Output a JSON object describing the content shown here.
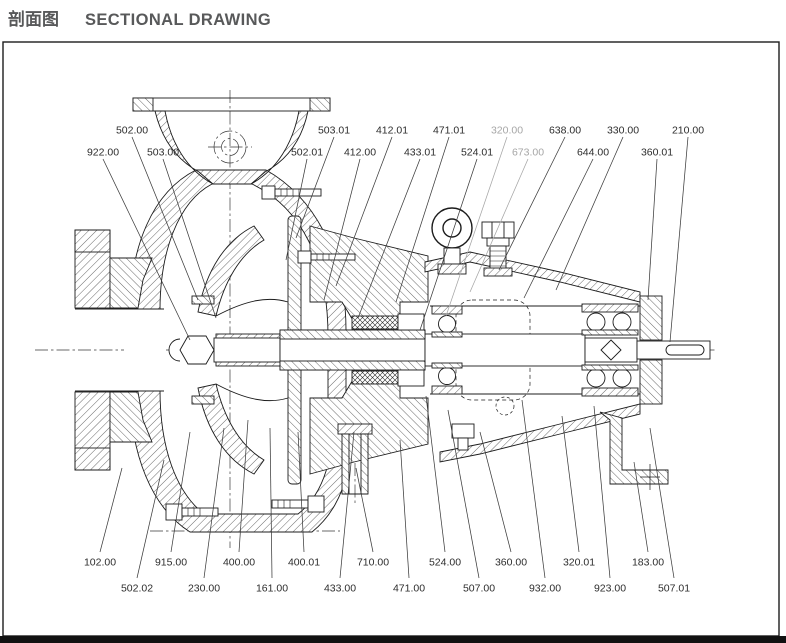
{
  "header": {
    "title_zh": "剖面图",
    "title_en": "SECTIONAL DRAWING"
  },
  "colors": {
    "title": "#58595a",
    "line": "#1c1c1c",
    "label": "#2d2d2d",
    "muted_label": "#a6a6a6",
    "frame": "#1c1c1c"
  },
  "drawing": {
    "type": "centrifugal-pump-sectional-drawing",
    "labels": [
      {
        "text": "502.00",
        "x": 132,
        "y": 130,
        "tx": 198,
        "ty": 300,
        "row": "top",
        "muted": false
      },
      {
        "text": "503.01",
        "x": 334,
        "y": 130,
        "tx": 296,
        "ty": 238,
        "row": "top",
        "muted": false
      },
      {
        "text": "412.01",
        "x": 392,
        "y": 130,
        "tx": 336,
        "ty": 286,
        "row": "top",
        "muted": false
      },
      {
        "text": "471.01",
        "x": 449,
        "y": 130,
        "tx": 396,
        "ty": 302,
        "row": "top",
        "muted": false
      },
      {
        "text": "320.00",
        "x": 507,
        "y": 130,
        "tx": 446,
        "ty": 316,
        "row": "top",
        "muted": true
      },
      {
        "text": "638.00",
        "x": 565,
        "y": 130,
        "tx": 499,
        "ty": 270,
        "row": "top",
        "muted": false
      },
      {
        "text": "330.00",
        "x": 623,
        "y": 130,
        "tx": 556,
        "ty": 290,
        "row": "top",
        "muted": false
      },
      {
        "text": "210.00",
        "x": 688,
        "y": 130,
        "tx": 670,
        "ty": 342,
        "row": "top",
        "muted": false
      },
      {
        "text": "922.00",
        "x": 103,
        "y": 152,
        "tx": 190,
        "ty": 340,
        "row": "top",
        "muted": false
      },
      {
        "text": "503.00",
        "x": 163,
        "y": 152,
        "tx": 216,
        "ty": 318,
        "row": "top",
        "muted": false
      },
      {
        "text": "502.01",
        "x": 307,
        "y": 152,
        "tx": 286,
        "ty": 260,
        "row": "top",
        "muted": false
      },
      {
        "text": "412.00",
        "x": 360,
        "y": 152,
        "tx": 324,
        "ty": 300,
        "row": "top",
        "muted": false
      },
      {
        "text": "433.01",
        "x": 420,
        "y": 152,
        "tx": 358,
        "ty": 318,
        "row": "top",
        "muted": false
      },
      {
        "text": "524.01",
        "x": 477,
        "y": 152,
        "tx": 420,
        "ty": 330,
        "row": "top",
        "muted": false
      },
      {
        "text": "673.00",
        "x": 528,
        "y": 152,
        "tx": 470,
        "ty": 292,
        "row": "top",
        "muted": true
      },
      {
        "text": "644.00",
        "x": 593,
        "y": 152,
        "tx": 524,
        "ty": 298,
        "row": "top",
        "muted": false
      },
      {
        "text": "360.01",
        "x": 657,
        "y": 152,
        "tx": 648,
        "ty": 300,
        "row": "top",
        "muted": false
      },
      {
        "text": "102.00",
        "x": 100,
        "y": 562,
        "tx": 122,
        "ty": 468,
        "row": "bottom",
        "muted": false
      },
      {
        "text": "915.00",
        "x": 171,
        "y": 562,
        "tx": 190,
        "ty": 432,
        "row": "bottom",
        "muted": false
      },
      {
        "text": "400.00",
        "x": 239,
        "y": 562,
        "tx": 248,
        "ty": 420,
        "row": "bottom",
        "muted": false
      },
      {
        "text": "400.01",
        "x": 304,
        "y": 562,
        "tx": 298,
        "ty": 432,
        "row": "bottom",
        "muted": false
      },
      {
        "text": "710.00",
        "x": 373,
        "y": 562,
        "tx": 356,
        "ty": 468,
        "row": "bottom",
        "muted": false
      },
      {
        "text": "524.00",
        "x": 445,
        "y": 562,
        "tx": 426,
        "ty": 396,
        "row": "bottom",
        "muted": false
      },
      {
        "text": "360.00",
        "x": 511,
        "y": 562,
        "tx": 480,
        "ty": 432,
        "row": "bottom",
        "muted": false
      },
      {
        "text": "320.01",
        "x": 579,
        "y": 562,
        "tx": 562,
        "ty": 416,
        "row": "bottom",
        "muted": false
      },
      {
        "text": "183.00",
        "x": 648,
        "y": 562,
        "tx": 634,
        "ty": 462,
        "row": "bottom",
        "muted": false
      },
      {
        "text": "502.02",
        "x": 137,
        "y": 588,
        "tx": 164,
        "ty": 460,
        "row": "bottom",
        "muted": false
      },
      {
        "text": "230.00",
        "x": 204,
        "y": 588,
        "tx": 224,
        "ty": 428,
        "row": "bottom",
        "muted": false
      },
      {
        "text": "161.00",
        "x": 272,
        "y": 588,
        "tx": 270,
        "ty": 428,
        "row": "bottom",
        "muted": false
      },
      {
        "text": "433.00",
        "x": 340,
        "y": 588,
        "tx": 354,
        "ty": 432,
        "row": "bottom",
        "muted": false
      },
      {
        "text": "471.00",
        "x": 409,
        "y": 588,
        "tx": 400,
        "ty": 440,
        "row": "bottom",
        "muted": false
      },
      {
        "text": "507.00",
        "x": 479,
        "y": 588,
        "tx": 448,
        "ty": 410,
        "row": "bottom",
        "muted": false
      },
      {
        "text": "932.00",
        "x": 545,
        "y": 588,
        "tx": 522,
        "ty": 400,
        "row": "bottom",
        "muted": false
      },
      {
        "text": "923.00",
        "x": 610,
        "y": 588,
        "tx": 594,
        "ty": 406,
        "row": "bottom",
        "muted": false
      },
      {
        "text": "507.01",
        "x": 674,
        "y": 588,
        "tx": 650,
        "ty": 428,
        "row": "bottom",
        "muted": false
      }
    ]
  }
}
